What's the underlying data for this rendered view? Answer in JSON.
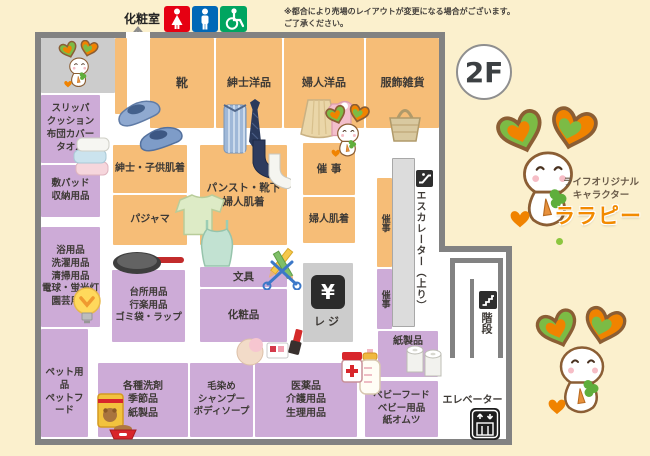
{
  "floor_badge": "2F",
  "restroom_label": "化粧室",
  "disclaimer": [
    "※都合により売場のレイアウトが変更になる場合がございます。",
    "ご了承ください。"
  ],
  "mascot": {
    "caption": [
      "ライフオリジナル",
      "キャラクター"
    ],
    "name": "ララピー"
  },
  "facilities": {
    "escalator": "エスカレーター（上り）",
    "stairs": "階段",
    "elevator": "エレベーター",
    "register": "レジ",
    "yen": "¥"
  },
  "sections": {
    "shoes": "靴",
    "mens_clothing": "紳士洋品",
    "womens_clothing": "婦人洋品",
    "fashion_goods": "服飾雑貨",
    "slippers": [
      "スリッパ",
      "クッション",
      "布団カバー",
      "タオル"
    ],
    "bedpad": [
      "敷パッド",
      "収納用品"
    ],
    "bath_cleaning": [
      "浴用品",
      "洗濯用品",
      "清掃用品",
      "電球・蛍光灯",
      "園芸用品"
    ],
    "pet": [
      "ペット用品",
      "ペットフード"
    ],
    "mens_kids_underwear": "紳士・子供肌着",
    "pajamas": "パジャマ",
    "pantyhose_underwear": [
      "パンスト・靴下",
      "婦人肌着"
    ],
    "event_1": "催 事",
    "womens_underwear": "婦人肌着",
    "event_2": "催事",
    "event_3": "催事",
    "kitchen": [
      "台所用品",
      "行楽用品",
      "ゴミ袋・ラップ"
    ],
    "stationery": "文具",
    "cosmetics": "化粧品",
    "detergents": [
      "各種洗剤",
      "季節品",
      "紙製品"
    ],
    "hair_body": [
      "毛染め",
      "シャンプー",
      "ボディソープ"
    ],
    "medicine": [
      "医薬品",
      "介護用品",
      "生理用品"
    ],
    "paper_products": "紙製品",
    "baby": [
      "ベビーフード",
      "ベビー用品",
      "紙オムツ"
    ]
  },
  "colors": {
    "section_orange": "#F6BD77",
    "section_purple": "#CDABD7",
    "mascot_orange": "#F08300",
    "mascot_green": "#7CBB45",
    "restroom_women_red": "#E60012",
    "restroom_men_blue": "#0068B7",
    "wheelchair_green": "#00A560",
    "background_cream": "#FBF0CD"
  }
}
